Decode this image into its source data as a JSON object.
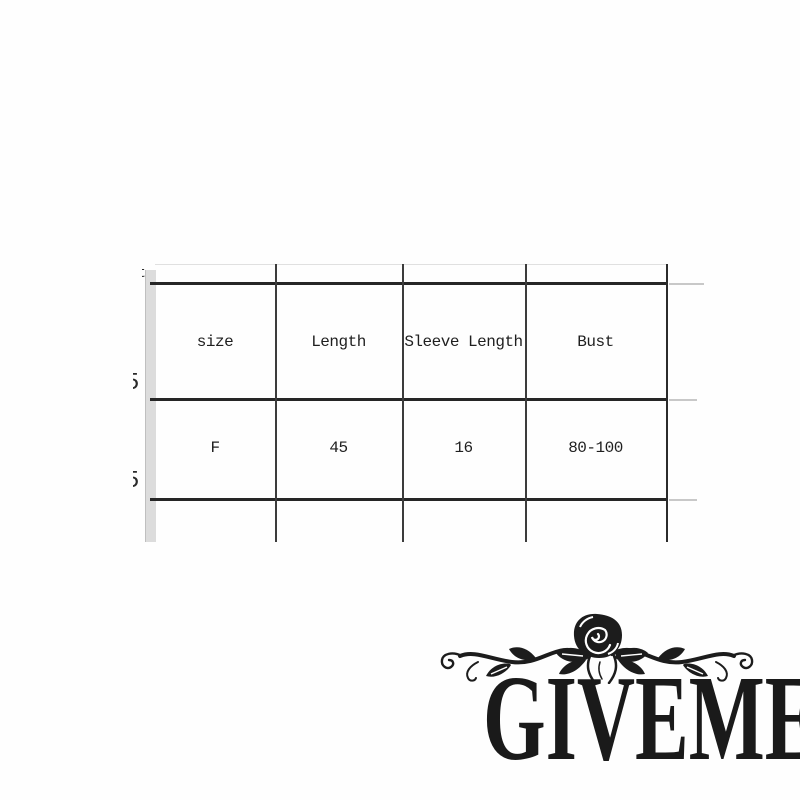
{
  "page": {
    "background": "#fefefe"
  },
  "size_chart": {
    "columns": [
      "size",
      "Length",
      "Sleeve Length",
      "Bust"
    ],
    "rows": [
      [
        "F",
        "45",
        "16",
        "80-100"
      ]
    ],
    "clipped_fragments": [
      "t",
      "5",
      "5"
    ],
    "colors": {
      "border": "#262626",
      "thin_line": "#3c3c3c",
      "grid_stub": "#c8c8c8",
      "side_strip": "#dcdcdc",
      "text": "#1f1f1f"
    }
  },
  "watermark": {
    "text": "GIVEME5",
    "color": "#1a1a1a",
    "ornament": "rose-flourish"
  }
}
